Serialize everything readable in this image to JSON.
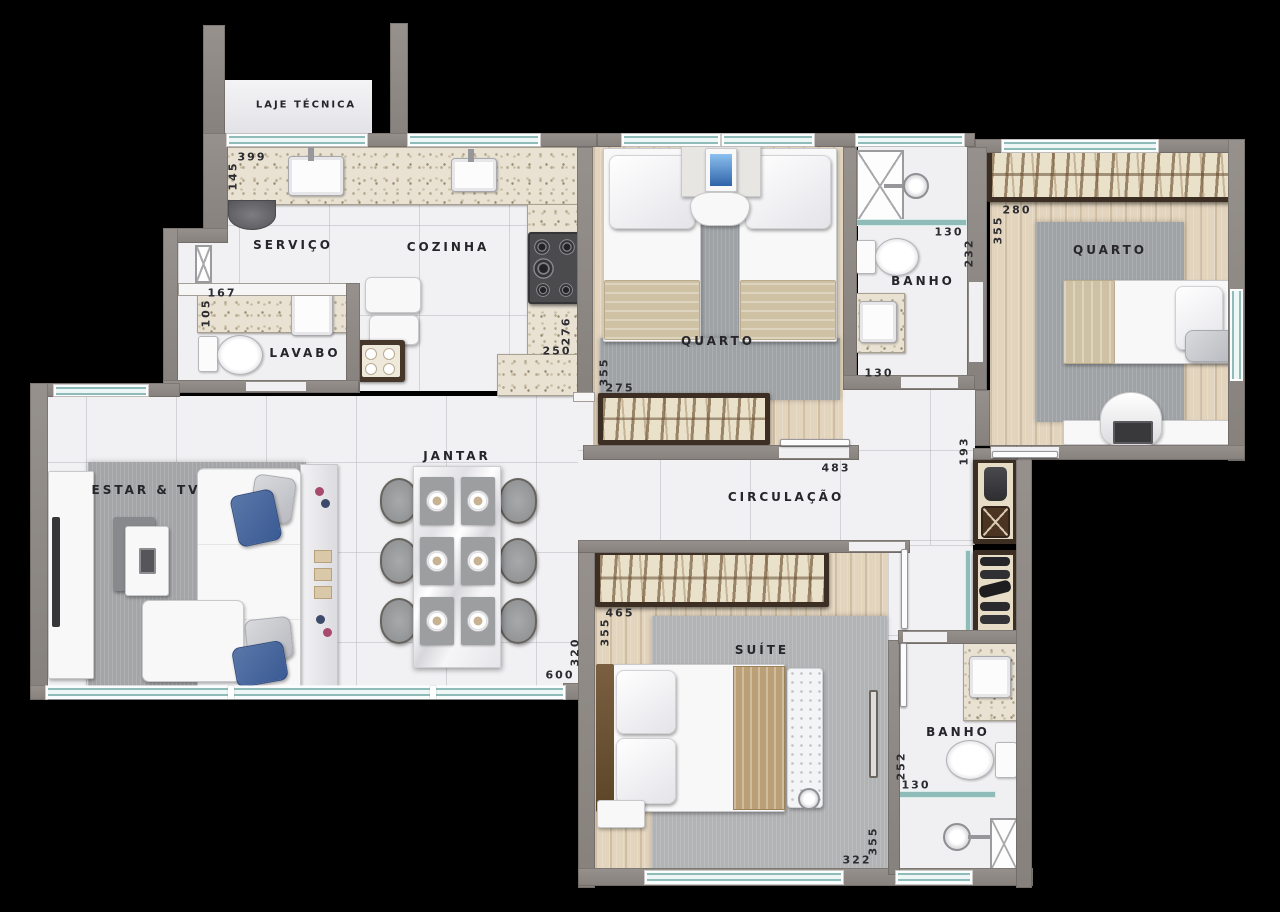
{
  "rooms": {
    "laje_tecnica": "LAJE TÉCNICA",
    "servico": "SERVIÇO",
    "cozinha": "COZINHA",
    "lavabo": "LAVABO",
    "quarto_1": "QUARTO",
    "banho_social": "BANHO",
    "quarto_2": "QUARTO",
    "estar_tv": "ESTAR & TV",
    "jantar": "JANTAR",
    "circulacao": "CIRCULAÇÃO",
    "suite": "SUÍTE",
    "banho_suite": "BANHO"
  },
  "dimensions": {
    "servico_width": "399",
    "servico_depth": "145",
    "lavabo_width": "167",
    "lavabo_depth": "105",
    "cozinha_depth": "276",
    "cozinha_width": "250",
    "quarto1_depth": "355",
    "quarto1_width": "275",
    "banho_social_door": "130",
    "banho_social_shower": "130",
    "banho_social_depth": "232",
    "quarto2_width": "280",
    "quarto2_depth": "355",
    "circulacao_width": "483",
    "circulacao_depth": "193",
    "suite_closet_width": "465",
    "suite_depth_upper": "355",
    "estar_depth": "320",
    "estar_width": "600",
    "banho_suite_depth": "252",
    "banho_suite_shower": "130",
    "suite_depth_lower": "355",
    "suite_width": "322"
  },
  "palette": {
    "background": "#000000",
    "wall": "#8d8884",
    "floor_tile": "#f1f1f3",
    "wood_floor": "#e2d4bd",
    "granite": "#e9e2d3",
    "rug": "#a4a5a7",
    "window_glass": "#8fbcb9",
    "closet_frame": "#3c2e22",
    "accent_blue": "#46629b"
  }
}
